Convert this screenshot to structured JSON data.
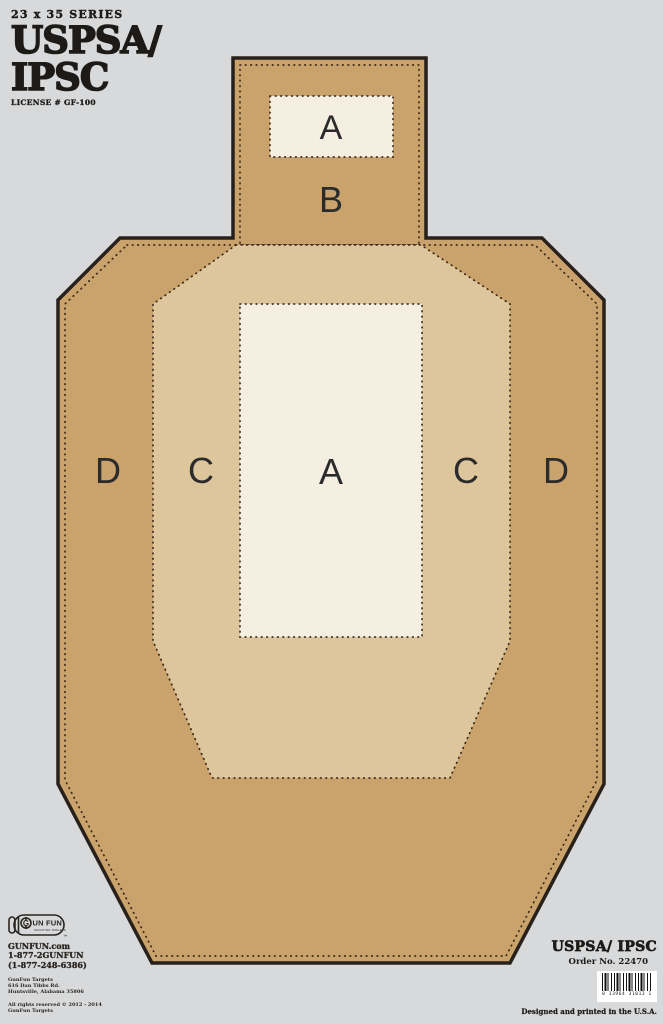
{
  "header": {
    "series": "23 x 35 SERIES",
    "title_line1": "USPSA/",
    "title_line2": "IPSC",
    "license": "LICENSE # GF-100"
  },
  "target": {
    "colors": {
      "background": "#d7d9da",
      "cardboard": "#c9a36b",
      "c_zone": "#ddc59c",
      "a_zone": "#f5efe2",
      "outline": "#28211b"
    },
    "head": {
      "a_label": "A",
      "b_label": "B"
    },
    "body": {
      "d_left": "D",
      "c_left": "C",
      "a_label": "A",
      "c_right": "C",
      "d_right": "D"
    }
  },
  "footer_left": {
    "logo": {
      "g_letter": "G",
      "name_rest": "UN FUN",
      "tagline": "SHOOTING TARGETS",
      "trademark": "™"
    },
    "website": "GUNFUN.com",
    "phone_vanity": "1-877-2GUNFUN",
    "phone_number": "(1-877-248-6386)",
    "company": "GunFun Targets",
    "address_line1": "616 Dan Tibbs Rd.",
    "address_line2": "Huntsville, Alabama 35806",
    "copyright_line1": "All rights reserved © 2012 - 2014",
    "copyright_line2": "GunFun Targets"
  },
  "footer_right": {
    "title": "USPSA/ IPSC",
    "order_no": "Order No. 22470",
    "barcode_digits": "0 13964 31013 1",
    "printed_note": "Designed and printed in the U.S.A."
  }
}
